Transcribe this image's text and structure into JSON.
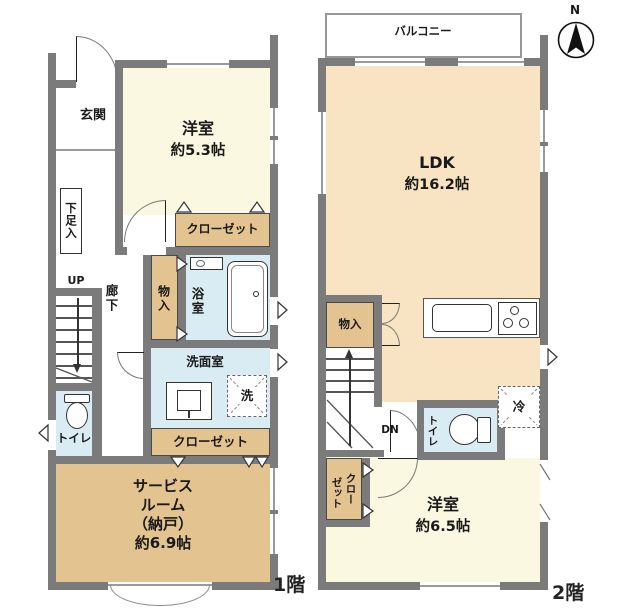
{
  "colors": {
    "wall": "#7b7b7b",
    "room_cream": "#FAF8E1",
    "room_peach": "#F8E4C2",
    "room_tan": "#E3C491",
    "room_blue": "#D9ECF3"
  },
  "compass": {
    "label": "N"
  },
  "floor1": {
    "floor_label": "1階",
    "entrance": "玄関",
    "bedroom": {
      "name": "洋室",
      "size": "約5.3帖"
    },
    "closet_top": "クローゼット",
    "shoe_cabinet": "下足入",
    "stairs": "UP",
    "hallway": "廊下",
    "storage": "物入",
    "bathroom": "浴室",
    "washroom": "洗面室",
    "washer": "洗",
    "toilet": "トイレ",
    "closet_bottom": "クローゼット",
    "service_room": {
      "line1": "サービス",
      "line2": "ルーム",
      "line3": "（納戸）",
      "line4": "約6.9帖"
    }
  },
  "floor2": {
    "floor_label": "2階",
    "balcony": "バルコニー",
    "ldk": {
      "name": "LDK",
      "size": "約16.2帖"
    },
    "storage": "物入",
    "stairs": "DN",
    "toilet": "トイレ",
    "refrigerator": "冷",
    "closet": [
      "クロー",
      "ゼット"
    ],
    "bedroom": {
      "name": "洋室",
      "size": "約6.5帖"
    }
  }
}
